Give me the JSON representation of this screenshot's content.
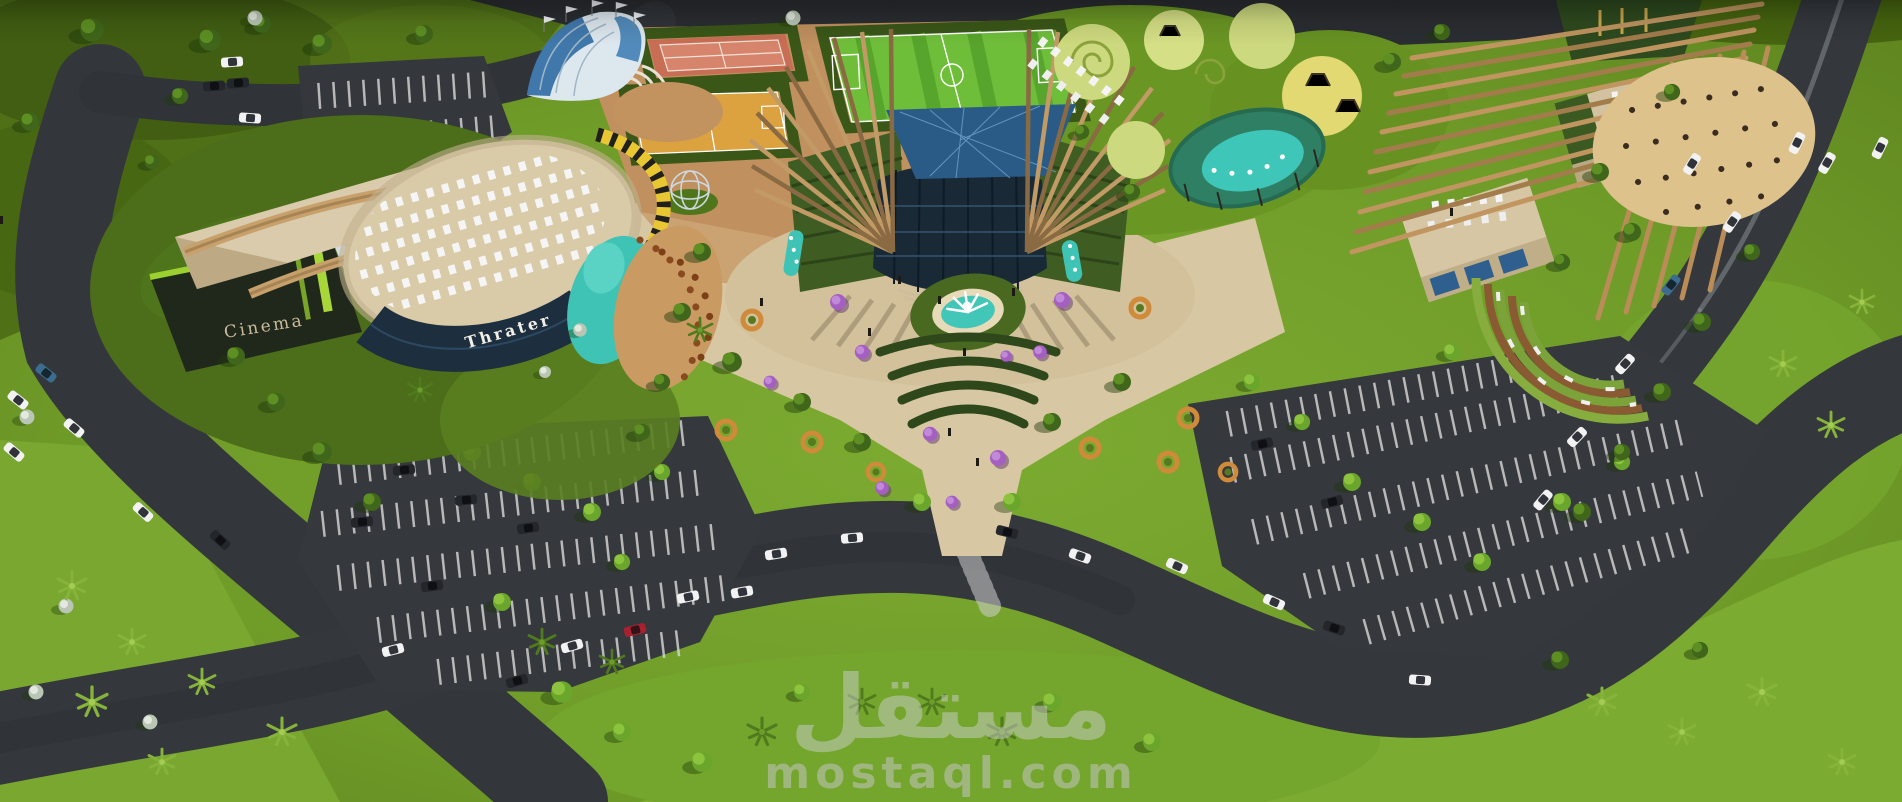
{
  "scene": {
    "description": "Aerial 3D architectural render of a cultural and entertainment complex",
    "buildings": {
      "cinema_label": "Cinema",
      "theater_label": "Thrater"
    },
    "watermark": {
      "logo": "مستقل",
      "domain": "mostaql.com"
    },
    "palette": {
      "grass": "#6f9b28",
      "grass_bright": "#7fb033",
      "grass_dark": "#4b6a15",
      "asphalt": "#33373c",
      "plaza_beige": "#d8c7a3",
      "path_bronze": "#c0905f",
      "water_teal": "#3ec3b5",
      "tennis_clay": "#c86e54",
      "basketball_orange": "#dba23f",
      "pitch_green": "#6fbe3a",
      "wood": "#c7a06b",
      "glass_dark": "#1a2936",
      "canopy_blue": "#2a5b86",
      "roof_green": "#3f5d23",
      "hazard_yellow": "#e9c733",
      "flower_purple": "#a55fc0",
      "sand": "#dec28b"
    }
  }
}
